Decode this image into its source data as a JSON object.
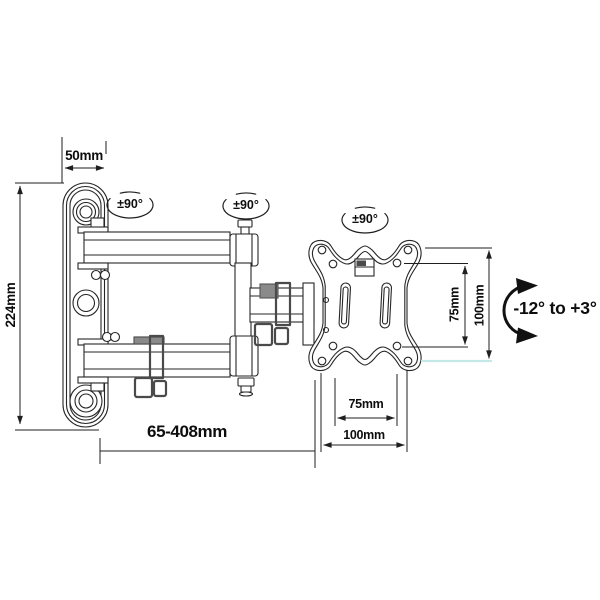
{
  "diagram": {
    "kind": "technical-dimension-drawing",
    "subject": "Articulating TV wall mount bracket with swivel arms and VESA plate",
    "background": "#ffffff",
    "line_color": "#262626",
    "highlight_line_color": "#c4e8e6"
  },
  "dimension_labels": {
    "wall_plate_width": "50mm",
    "wall_plate_height": "224mm",
    "extension_range": "65-408mm",
    "vesa_vertical_75": "75mm",
    "vesa_vertical_100": "100mm",
    "vesa_horizontal_75": "75mm",
    "vesa_horizontal_100": "100mm"
  },
  "motion_labels": {
    "swivel_joint_1": "±90°",
    "swivel_joint_2": "±90°",
    "swivel_joint_3": "±90°",
    "tilt_range": "-12° to +3°"
  }
}
